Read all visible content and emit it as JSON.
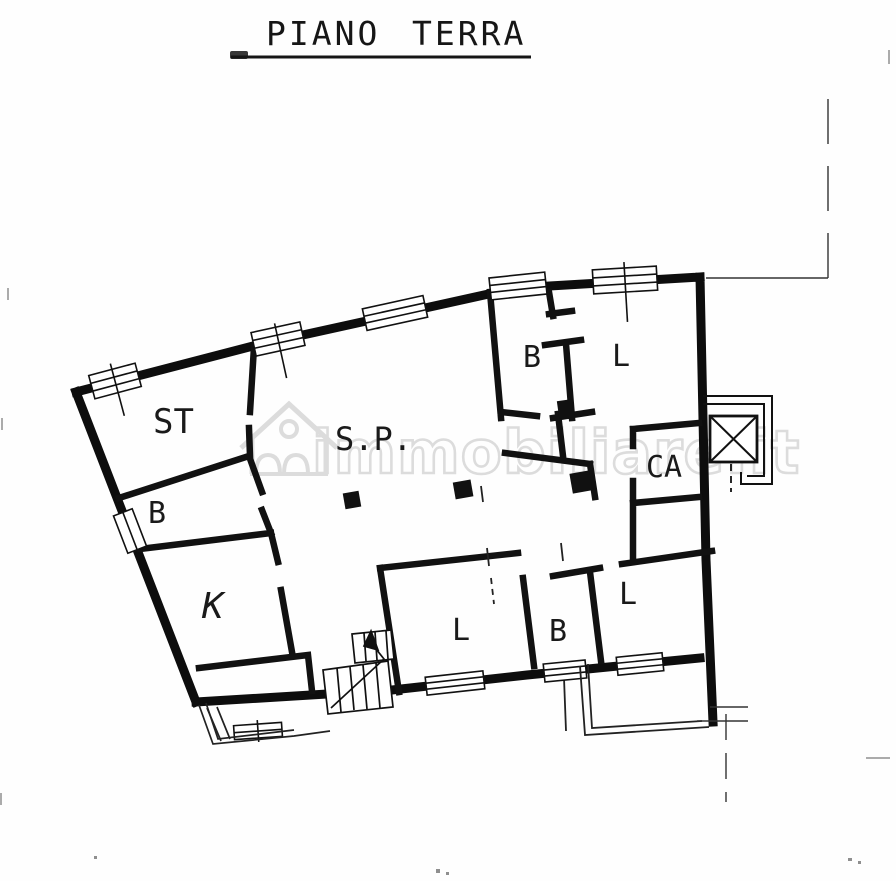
{
  "document": {
    "type": "scanned-floor-plan",
    "title": {
      "words": [
        "PIANO",
        "TERRA"
      ]
    }
  },
  "watermark": {
    "text": "immobiliare.it",
    "icon": "house-icon",
    "color": "#dcdcdc"
  },
  "floor_plan": {
    "rooms": [
      {
        "label": "ST"
      },
      {
        "label": "B"
      },
      {
        "label": "S.P."
      },
      {
        "label": "B"
      },
      {
        "label": "L"
      },
      {
        "label": "CA"
      },
      {
        "label": "K"
      },
      {
        "label": "L"
      },
      {
        "label": "B"
      },
      {
        "label": "L"
      }
    ],
    "symbols": [
      "elevator",
      "staircase",
      "window",
      "door",
      "column",
      "balcony",
      "entrance-porch",
      "boundary-line"
    ],
    "colors": {
      "ink": "#141414",
      "paper": "#fefefe",
      "watermark": "#dcdcdc"
    }
  }
}
